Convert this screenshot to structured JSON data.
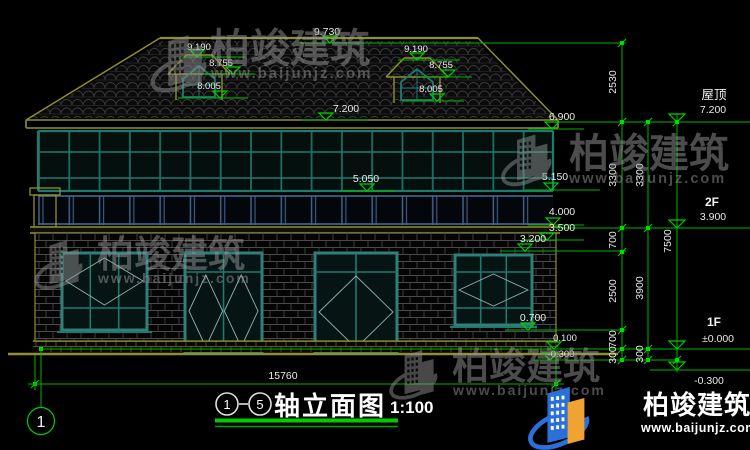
{
  "watermark": {
    "brand": "柏竣建筑",
    "url": "www.baijunjz.com"
  },
  "logo": {
    "brand": "柏竣建筑",
    "url": "www.baijunjz.com"
  },
  "levels": {
    "ridge": "9.730",
    "dormer_left": {
      "top": "9.190",
      "eave": "8.755",
      "sill": "8.005"
    },
    "dormer_right": {
      "top": "9.190",
      "eave": "8.755",
      "sill": "8.005"
    },
    "roof": "7.200",
    "eave": "6.900",
    "glazing_bottom_left": "5.050",
    "glazing_bottom_right": "5.150",
    "band_top": "4.000",
    "band_bottom": "3.500",
    "window_head": "3.200",
    "window_sill": "0.700",
    "plinth": "0.100",
    "ground": "-0.300"
  },
  "right_dims": {
    "inner": [
      "2530",
      "3300",
      "700",
      "2500",
      "700",
      "300"
    ],
    "middle": [
      "3300",
      "3900",
      "300"
    ],
    "total": "7500",
    "floors": {
      "roof_name": "屋顶",
      "roof_elev": "7.200",
      "f2_name": "2F",
      "f2_elev": "3.900",
      "f1_name": "1F",
      "f1_elev": "±0.000",
      "below_elev": "-0.300"
    }
  },
  "bottom": {
    "overall_width": "15760",
    "axis_bubble": "1"
  },
  "title": {
    "axis_start": "1",
    "axis_end": "5",
    "name": "轴立面图",
    "scale": "1:100"
  }
}
